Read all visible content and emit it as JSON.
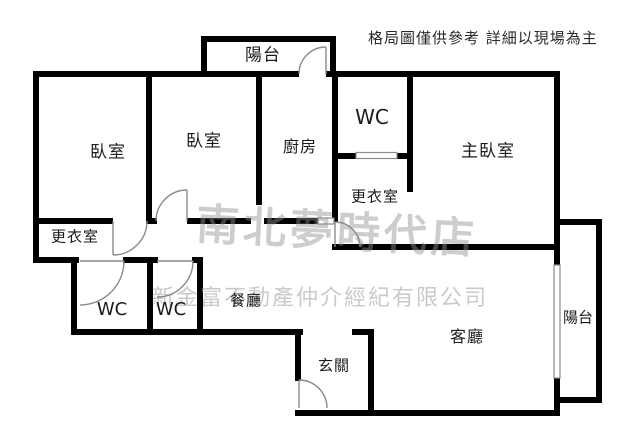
{
  "disclaimer": "格局圖僅供參考 詳細以現場為主",
  "watermarks": {
    "store": "南北夢時代店",
    "agency": "新金富不動產仲介經紀有限公司"
  },
  "colors": {
    "wall": "#000000",
    "door_line": "#8a8a8a",
    "watermark_gray": "#919191",
    "background": "#ffffff",
    "label_text": "#1a1a1a"
  },
  "labels": {
    "balcony_top": "陽台",
    "bedroom1": "臥室",
    "bedroom2": "臥室",
    "kitchen": "廚房",
    "wc_top": "WC",
    "master_bedroom": "主臥室",
    "dressing_right": "更衣室",
    "dressing_left": "更衣室",
    "wc_left": "WC",
    "wc_mid": "WC",
    "dining": "餐廳",
    "foyer": "玄關",
    "living": "客廳",
    "balcony_right": "陽台"
  }
}
